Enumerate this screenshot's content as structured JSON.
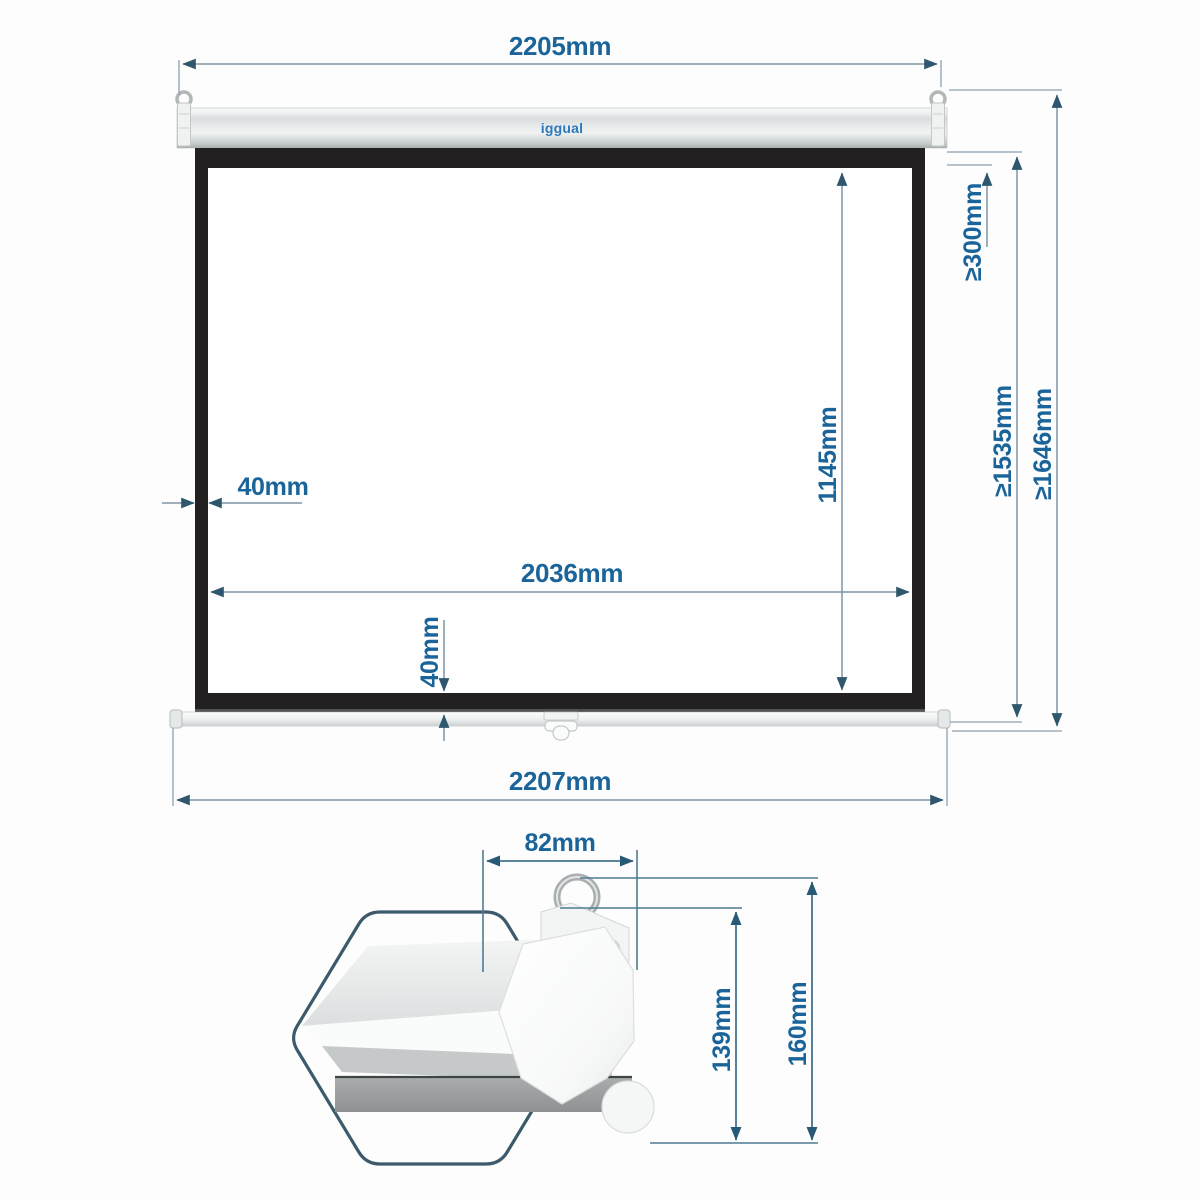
{
  "drawing_title": "projection-screen-dimension-drawing",
  "colors": {
    "dimension_text": "#1a649a",
    "dimension_line": "#7e94a3",
    "dimension_line_dark": "#44738c",
    "arrow": "#2e566d",
    "frame_black": "#232021",
    "logo_blue": "#2b7abc",
    "outline_hexagon": "#3c5a6b"
  },
  "front_view": {
    "logo": "iggual",
    "dimensions": {
      "case_width": "2205mm",
      "overall_width": "2207mm",
      "viewing_width": "2036mm",
      "left_border": "40mm",
      "bottom_border": "40mm",
      "viewing_height": "1145mm",
      "min_drop": "≥300mm",
      "min_screen_height": "≥1535mm",
      "min_total_height": "≥1646mm"
    }
  },
  "side_view": {
    "dimensions": {
      "case_depth": "82mm",
      "case_height": "139mm",
      "overall_height": "160mm"
    }
  }
}
